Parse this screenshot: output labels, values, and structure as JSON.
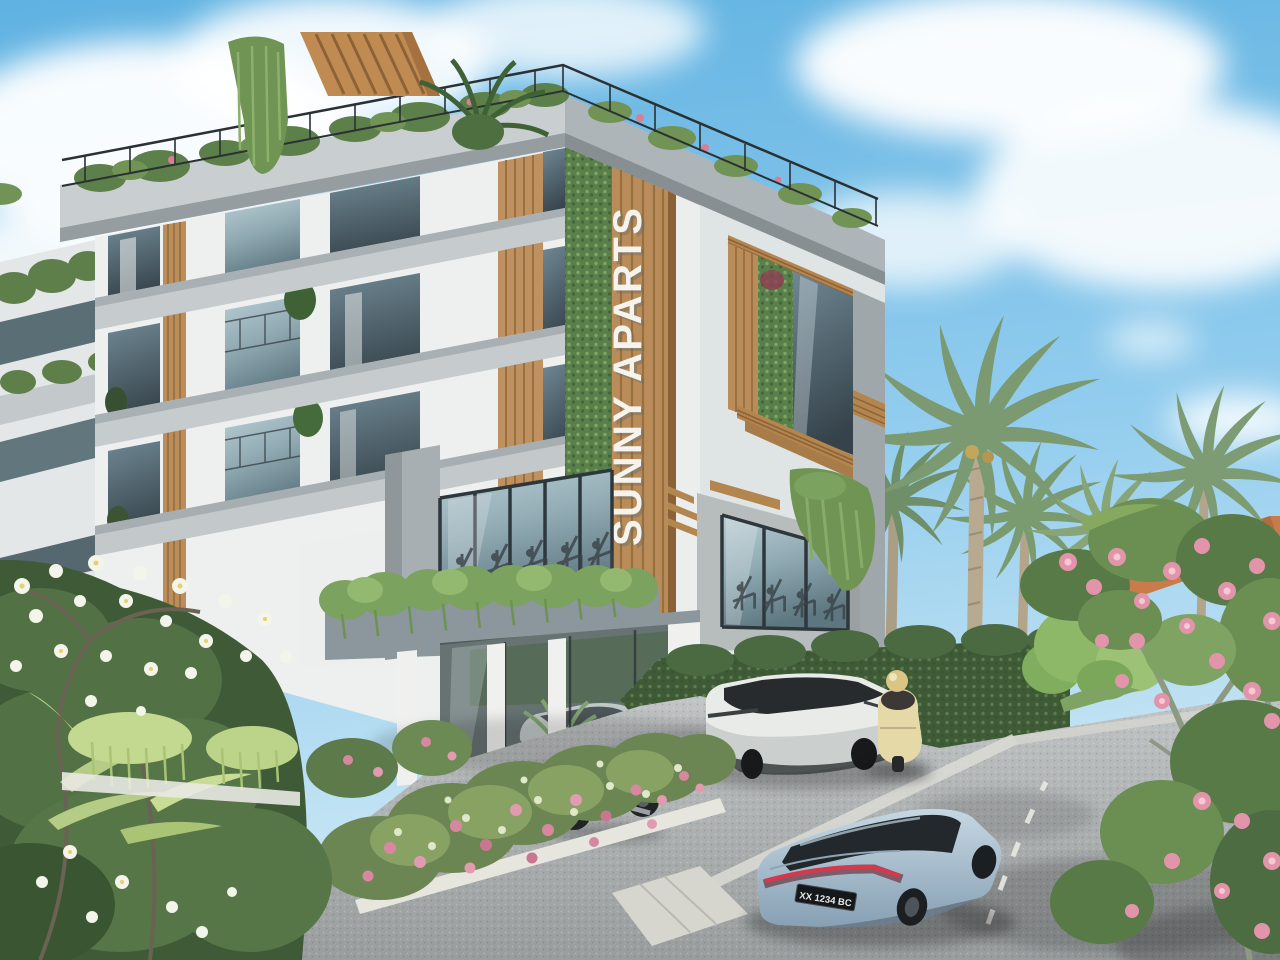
{
  "scene": {
    "description": "3D architectural render of a modern tropical apartment building with vertical gardens, rooftop terrace, palm trees, parked vehicles and a street in the foreground",
    "time_of_day": "day",
    "weather": "sunny with scattered white clouds"
  },
  "building": {
    "sign_text": "SUNNY APARTS",
    "floor_count_visible": 4,
    "features": [
      "rooftop wood pergola",
      "roof terrace with glass railing and planting",
      "vertical garden green walls",
      "vertical wood slat accents",
      "floor-to-ceiling glazing",
      "ground floor gym behind glass",
      "covered parking on pilotis",
      "planter boxes with trailing plants"
    ]
  },
  "vehicles": [
    {
      "id": "sedan",
      "label": "light blue electric sedan on street",
      "license_plate": "XX 1234 BC"
    },
    {
      "id": "suv",
      "label": "white crossover SUV parked under building"
    },
    {
      "id": "parked-car",
      "label": "silver car inside glazed parking bay"
    },
    {
      "id": "motorcycle",
      "label": "white motorcycle with red trellis frame"
    },
    {
      "id": "scooter",
      "label": "cream retro scooter with helmet"
    }
  ],
  "vegetation": {
    "left_foreground": "frangipani tree with white flowers over dense shrubs and light palm fronds",
    "center": "flower bed with pink and white roses on a white curb",
    "right_foreground": "frangipani tree with pink flowers",
    "background": "coconut palms, clipped dark hedge, light green trees"
  },
  "neighborhood": {
    "background_roof": "terracotta tiled roof behind palms"
  },
  "palette": {
    "sky_top": "#5fb2e2",
    "sky_low": "#d2eaf5",
    "concrete_light": "#c9ced1",
    "concrete_dark": "#9aa3a8",
    "wall_white": "#f0f1ef",
    "wood": "#b98c5a",
    "green_wall": "#59804a",
    "glass_dark": "#44535b",
    "road": "#a9acad",
    "sedan_blue": "#a9c2d6",
    "taillight_red": "#c92f3d",
    "flower_pink": "#e295aa",
    "terracotta": "#c87c4b"
  }
}
